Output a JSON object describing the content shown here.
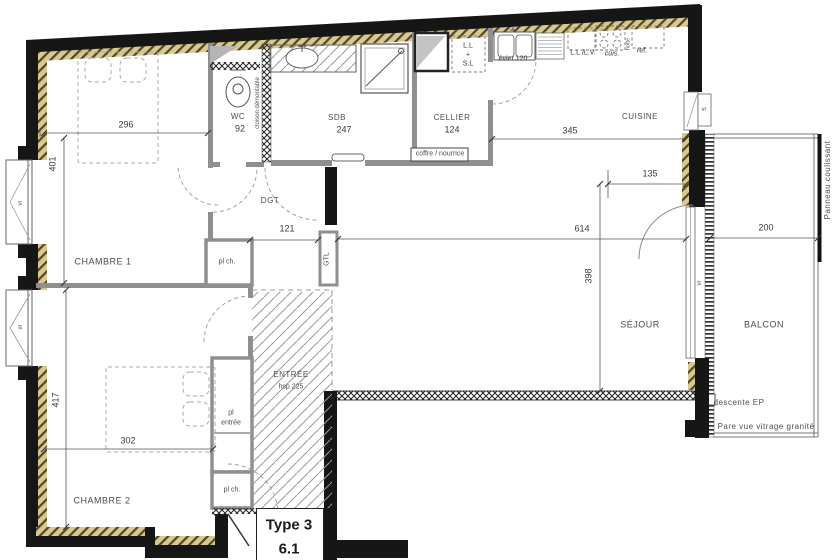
{
  "meta": {
    "type_label": "Type 3",
    "lot_number": "6.1"
  },
  "rooms": {
    "chambre1": {
      "name": "CHAMBRE 1",
      "width": "296",
      "height": "401"
    },
    "chambre2": {
      "name": "CHAMBRE 2",
      "width": "302",
      "height": "417"
    },
    "wc": {
      "name": "WC",
      "dim": "92"
    },
    "sdb": {
      "name": "SDB",
      "dim": "247"
    },
    "cellier": {
      "name": "CELLIER",
      "dim": "124"
    },
    "cuisine": {
      "name": "CUISINE",
      "dim": "345",
      "dim2": "135"
    },
    "sejour": {
      "name": "SÉJOUR",
      "width": "614",
      "height": "398"
    },
    "balcon": {
      "name": "BALCON",
      "dim": "200"
    },
    "dgt": {
      "name": "DGT",
      "dim": "121"
    },
    "entree": {
      "name": "ENTRÉE",
      "ceiling": "hsp 225"
    }
  },
  "closets": {
    "pl_ch": "pl ch.",
    "pl_entree_line1": "pl",
    "pl_entree_line2": "entrée"
  },
  "annotations": {
    "cloison": "cloison démontable",
    "gtl": "GTL",
    "coffre": "coffre / nourrice",
    "evier": "évier 120",
    "ll_lv": "L.L./L.V.",
    "cuis": "cuis.",
    "hotte": "hotte",
    "ref": "ref.",
    "ll": "L.L",
    "plus": "+",
    "sl": "S.L",
    "vr": "vr",
    "descente_ep": "descente EP",
    "pare_vue": "Pare vue vitrage granité",
    "panneau": "Panneau coulissant"
  },
  "colors": {
    "wall": "#161616",
    "partition": "#8f8f8f",
    "insulation": "#d9c98f",
    "hatch": "#9a9a9a"
  }
}
